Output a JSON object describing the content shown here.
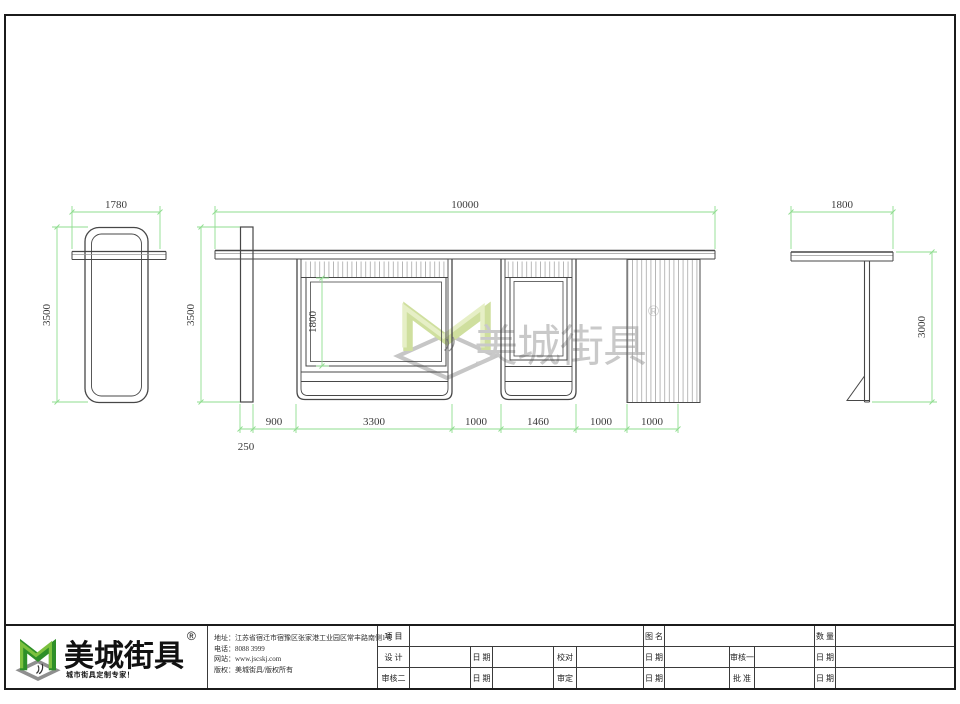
{
  "sheet": {
    "background": "#ffffff",
    "border_color": "#1b1b1b"
  },
  "colors": {
    "dimension_green": "#8fdd8f",
    "drawing_line": "#474747",
    "hatch_gray": "#9a9a9a",
    "logo_green": "#2e8f28",
    "logo_green_light": "#7cc13e",
    "logo_base_gray": "#8f8f8f",
    "watermark_green": "#cfdf9e",
    "watermark_gray": "#c9c9c9"
  },
  "views": {
    "left_side_view": {
      "width_dim": "1780",
      "height_dim": "3500"
    },
    "front_view": {
      "width_dim": "10000",
      "height_dim": "3500",
      "lightbox_height_dim": "1800",
      "post_width_dim": "250",
      "bottom_dims": [
        "900",
        "3300",
        "1000",
        "1460",
        "1000",
        "1000"
      ]
    },
    "right_side_view": {
      "width_dim": "1800",
      "height_dim": "3000"
    }
  },
  "watermark": {
    "brand": "美城街具",
    "registered": "®"
  },
  "title_block": {
    "logo": {
      "brand": "美城街具",
      "registered": "®",
      "tagline": "城市街具定制专家！"
    },
    "company": {
      "address_label": "地址：",
      "address": "江苏省宿迁市宿豫区张家港工业园区常丰路南侧1号",
      "phone_label": "电话：",
      "phone": "8088 3999",
      "website_label": "网站：",
      "website": "www.jscskj.com",
      "copyright_label": "版权：",
      "copyright": "美城街具/版权所有"
    },
    "table": {
      "r1": [
        "项 目",
        "图 名",
        "数 量"
      ],
      "r2": [
        "设 计",
        "日 期",
        "校对",
        "日 期",
        "审核一",
        "日 期"
      ],
      "r3": [
        "审核二",
        "日 期",
        "审定",
        "日 期",
        "批 准",
        "日 期"
      ]
    }
  }
}
